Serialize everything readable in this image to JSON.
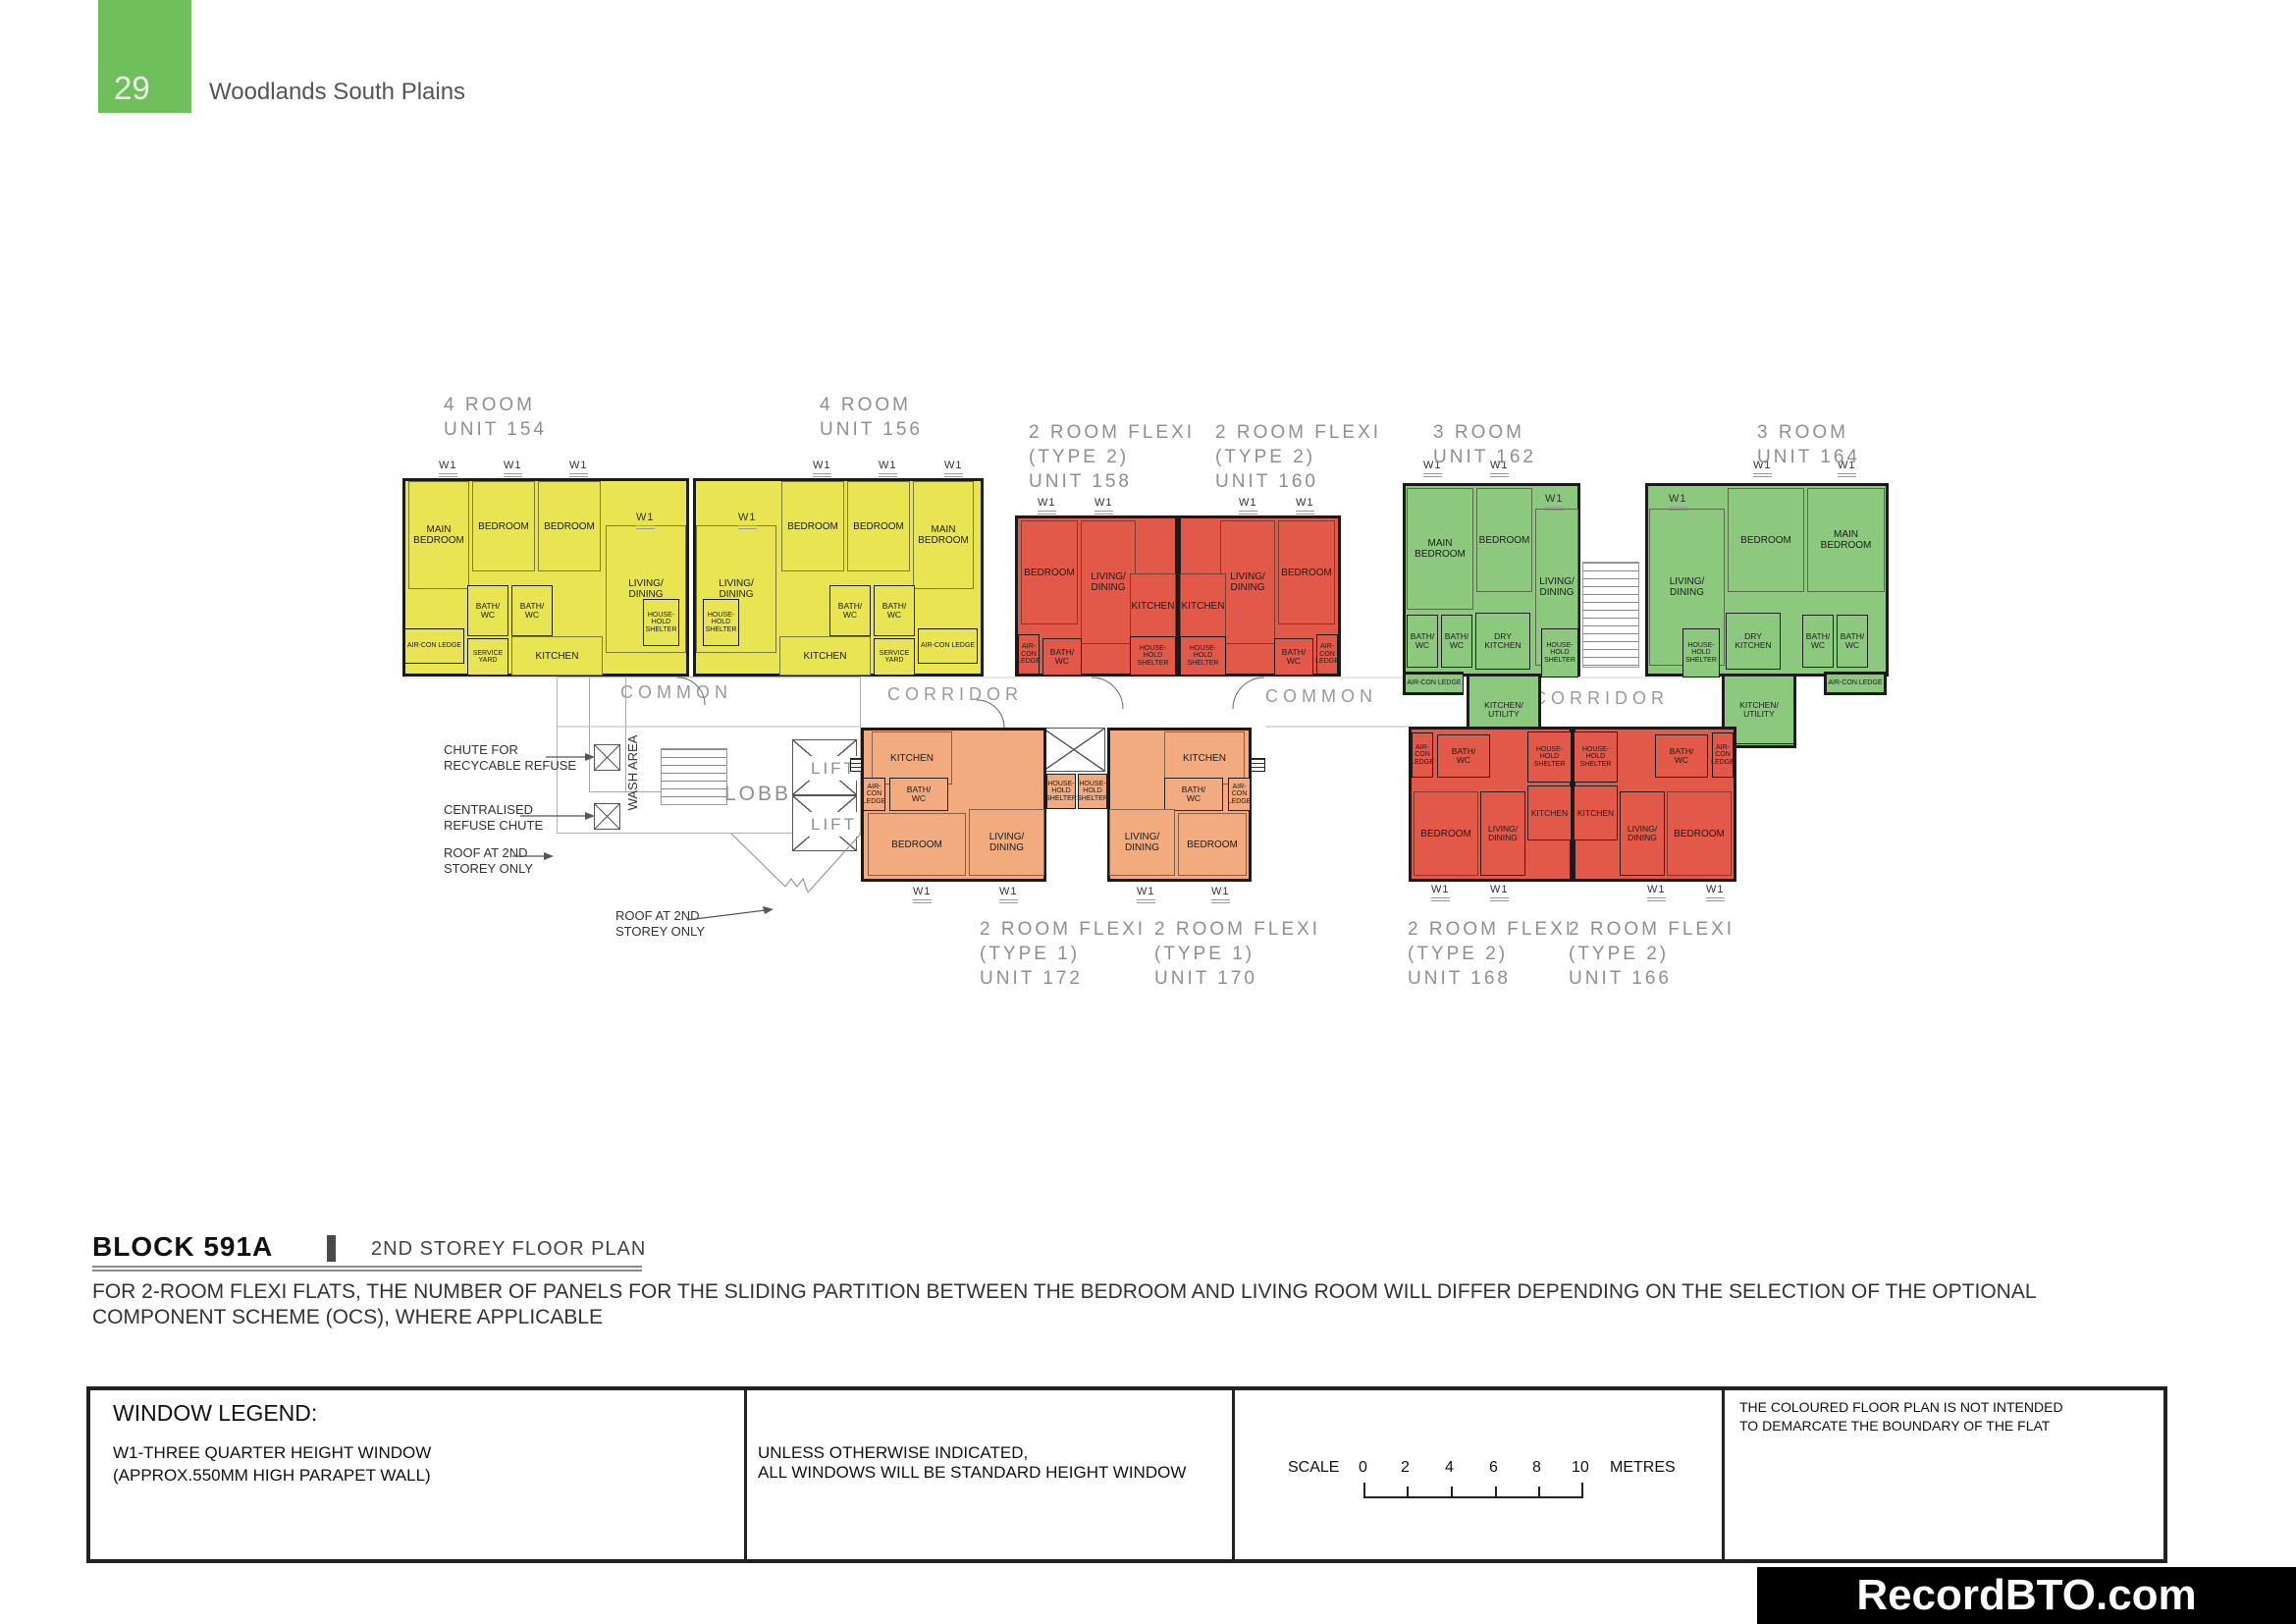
{
  "page": {
    "number": "29",
    "title": "Woodlands South Plains",
    "accent_color": "#6fbf5c"
  },
  "plan": {
    "window_mark": "W1",
    "corridor_labels": [
      "COMMON",
      "CORRIDOR",
      "COMMON",
      "CORRIDOR"
    ],
    "core": {
      "wash_area": "WASH AREA",
      "lobby": "LOBBY",
      "lift": "LIFT",
      "chute_recyclable": "CHUTE FOR\nRECYCABLE REFUSE",
      "chute_centralised": "CENTRALISED\nREFUSE CHUTE",
      "roof_note": "ROOF AT 2ND\nSTOREY ONLY"
    },
    "unit_colors": {
      "yellow": "#e9e552",
      "red": "#e2594a",
      "green": "#8cc97e",
      "orange": "#f2ab7e"
    },
    "units": [
      {
        "id": "154",
        "title": "4 ROOM\nUNIT 154",
        "color": "#e9e552",
        "rooms": [
          "MAIN\nBEDROOM",
          "BEDROOM",
          "BEDROOM",
          "LIVING/\nDINING",
          "BATH/\nWC",
          "BATH/\nWC",
          "AIR-CON LEDGE",
          "SERVICE\nYARD",
          "KITCHEN",
          "HOUSE-\nHOLD\nSHELTER"
        ]
      },
      {
        "id": "156",
        "title": "4 ROOM\nUNIT 156",
        "color": "#e9e552",
        "rooms": [
          "MAIN\nBEDROOM",
          "BEDROOM",
          "BEDROOM",
          "LIVING/\nDINING",
          "BATH/\nWC",
          "BATH/\nWC",
          "AIR-CON LEDGE",
          "SERVICE\nYARD",
          "KITCHEN",
          "HOUSE-\nHOLD\nSHELTER"
        ]
      },
      {
        "id": "158",
        "title": "2 ROOM FLEXI\n(TYPE 2)\nUNIT 158",
        "color": "#e2594a",
        "rooms": [
          "BEDROOM",
          "LIVING/\nDINING",
          "KITCHEN",
          "AIR-\nCON\nLEDGE",
          "BATH/\nWC",
          "HOUSE-\nHOLD\nSHELTER"
        ]
      },
      {
        "id": "160",
        "title": "2 ROOM FLEXI\n(TYPE 2)\nUNIT 160",
        "color": "#e2594a",
        "rooms": [
          "BEDROOM",
          "LIVING/\nDINING",
          "KITCHEN",
          "AIR-\nCON\nLEDGE",
          "BATH/\nWC",
          "HOUSE-\nHOLD\nSHELTER"
        ]
      },
      {
        "id": "162",
        "title": "3 ROOM\nUNIT 162",
        "color": "#8cc97e",
        "rooms": [
          "MAIN\nBEDROOM",
          "BEDROOM",
          "LIVING/\nDINING",
          "BATH/\nWC",
          "BATH/\nWC",
          "DRY\nKITCHEN",
          "AIR-CON LEDGE",
          "KITCHEN/\nUTILITY",
          "HOUSE-\nHOLD\nSHELTER"
        ]
      },
      {
        "id": "164",
        "title": "3 ROOM\nUNIT 164",
        "color": "#8cc97e",
        "rooms": [
          "MAIN\nBEDROOM",
          "BEDROOM",
          "LIVING/\nDINING",
          "BATH/\nWC",
          "BATH/\nWC",
          "DRY\nKITCHEN",
          "AIR-CON LEDGE",
          "KITCHEN/\nUTILITY",
          "HOUSE-\nHOLD\nSHELTER"
        ]
      },
      {
        "id": "172",
        "title": "2 ROOM FLEXI\n(TYPE 1)\nUNIT 172",
        "color": "#f2ab7e",
        "rooms": [
          "KITCHEN",
          "AIR-\nCON\nLEDGE",
          "BATH/\nWC",
          "HOUSE-\nHOLD\nSHELTER",
          "BEDROOM",
          "LIVING/\nDINING"
        ]
      },
      {
        "id": "170",
        "title": "2 ROOM FLEXI\n(TYPE 1)\nUNIT 170",
        "color": "#f2ab7e",
        "rooms": [
          "KITCHEN",
          "AIR-\nCON\nLEDGE",
          "BATH/\nWC",
          "HOUSE-\nHOLD\nSHELTER",
          "BEDROOM",
          "LIVING/\nDINING"
        ]
      },
      {
        "id": "168",
        "title": "2 ROOM FLEXI\n(TYPE 2)\nUNIT 168",
        "color": "#e2594a",
        "rooms": [
          "AIR-\nCON\nLEDGE",
          "BATH/\nWC",
          "HOUSE-\nHOLD\nSHELTER",
          "KITCHEN",
          "LIVING/\nDINING",
          "BEDROOM"
        ]
      },
      {
        "id": "166",
        "title": "2 ROOM FLEXI\n(TYPE 2)\nUNIT 166",
        "color": "#e2594a",
        "rooms": [
          "AIR-\nCON\nLEDGE",
          "BATH/\nWC",
          "HOUSE-\nHOLD\nSHELTER",
          "KITCHEN",
          "LIVING/\nDINING",
          "BEDROOM"
        ]
      }
    ]
  },
  "footer": {
    "block_title": "BLOCK  591A",
    "plan_title": "2ND STOREY FLOOR PLAN",
    "note": "FOR 2-ROOM FLEXI FLATS, THE NUMBER OF PANELS FOR THE SLIDING PARTITION BETWEEN THE BEDROOM AND LIVING ROOM WILL DIFFER DEPENDING ON THE SELECTION OF THE OPTIONAL\nCOMPONENT SCHEME (OCS), WHERE APPLICABLE"
  },
  "legend": {
    "title": "WINDOW LEGEND:",
    "w1_line1": "W1-THREE QUARTER HEIGHT WINDOW",
    "w1_line2": "(APPROX.550MM HIGH PARAPET WALL)",
    "windows_note": "UNLESS OTHERWISE INDICATED,\nALL WINDOWS WILL BE STANDARD HEIGHT WINDOW",
    "scale_label": "SCALE",
    "scale_ticks": [
      "0",
      "2",
      "4",
      "6",
      "8",
      "10"
    ],
    "scale_unit": "METRES",
    "boundary_note": "THE COLOURED FLOOR PLAN IS NOT INTENDED\nTO DEMARCATE THE BOUNDARY OF THE FLAT"
  },
  "watermark": "RecordBTO.com"
}
